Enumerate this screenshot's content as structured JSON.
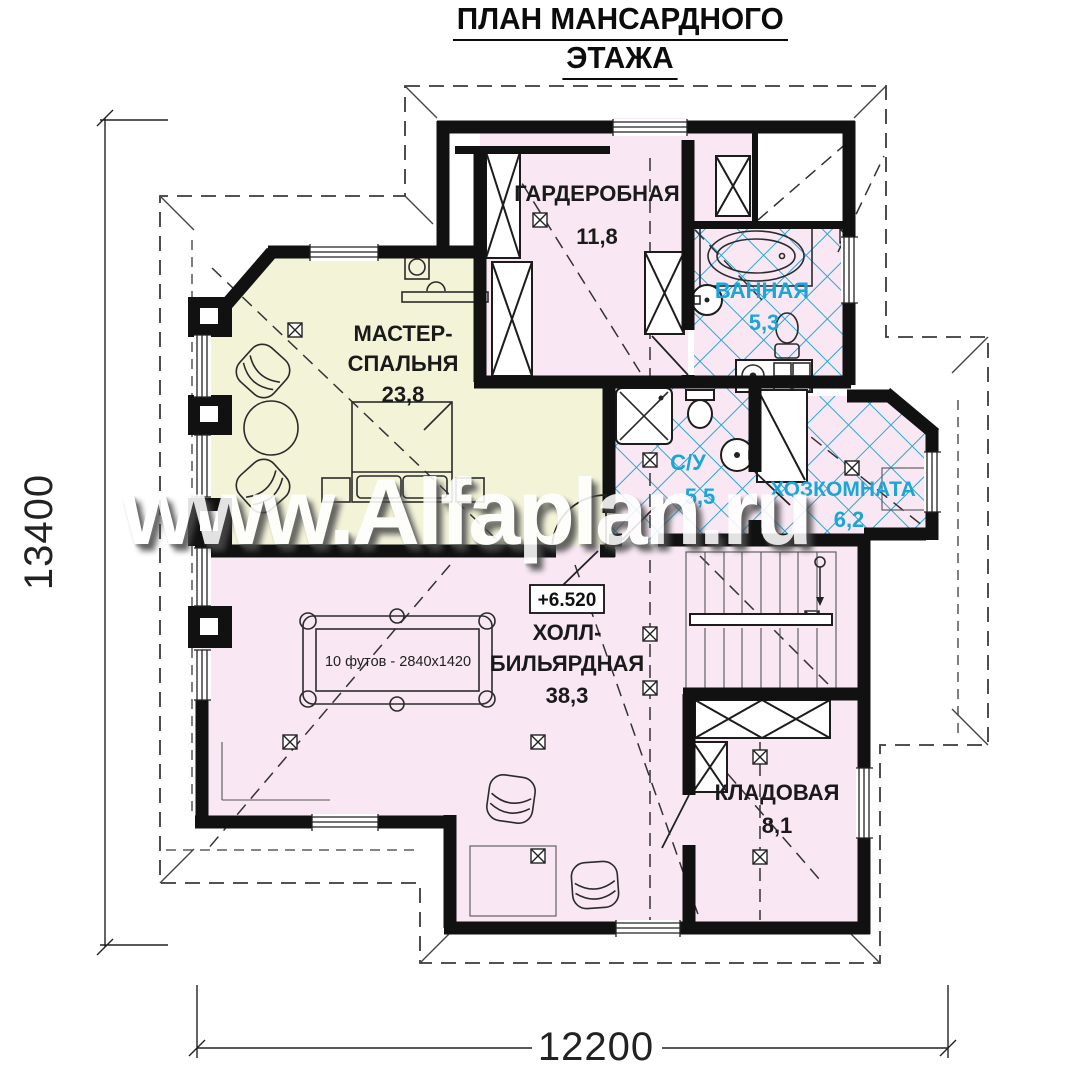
{
  "title": {
    "line1": "ПЛАН МАНСАРДНОГО",
    "line2": "ЭТАЖА"
  },
  "watermark": {
    "text": "www.Alfaplan.ru"
  },
  "rooms": {
    "wardrobe": {
      "name": "ГАРДЕРОБНАЯ",
      "area": "11,8"
    },
    "bathroom": {
      "name": "ВАННАЯ",
      "area": "5,3"
    },
    "master_bedroom": {
      "name_line1": "МАСТЕР-",
      "name_line2": "СПАЛЬНЯ",
      "area": "23,8"
    },
    "wc": {
      "name": "С/У",
      "area": "5,5"
    },
    "utility": {
      "name": "ХОЗКОМНАТА",
      "area": "6,2"
    },
    "hall_billiard": {
      "name_line1": "ХОЛЛ-",
      "name_line2": "БИЛЬЯРДНАЯ",
      "area": "38,3"
    },
    "storage": {
      "name": "КЛАДОВАЯ",
      "area": "8,1"
    }
  },
  "annotations": {
    "elevation_mark": "+6.520",
    "billiard_table_label": "10 футов - 2840x1420"
  },
  "dimensions": {
    "height_mm": "13400",
    "width_mm": "12200"
  },
  "colors": {
    "wall": "#111111",
    "room_pink": "#f9e8f4",
    "room_yellow": "#f3f3d8",
    "tile_line": "#2aa8d6",
    "wet_label": "#18a7d8",
    "label": "#1a1a1a",
    "roof_dash": "#3a3a3a",
    "watermark_fill": "#ffffff"
  }
}
